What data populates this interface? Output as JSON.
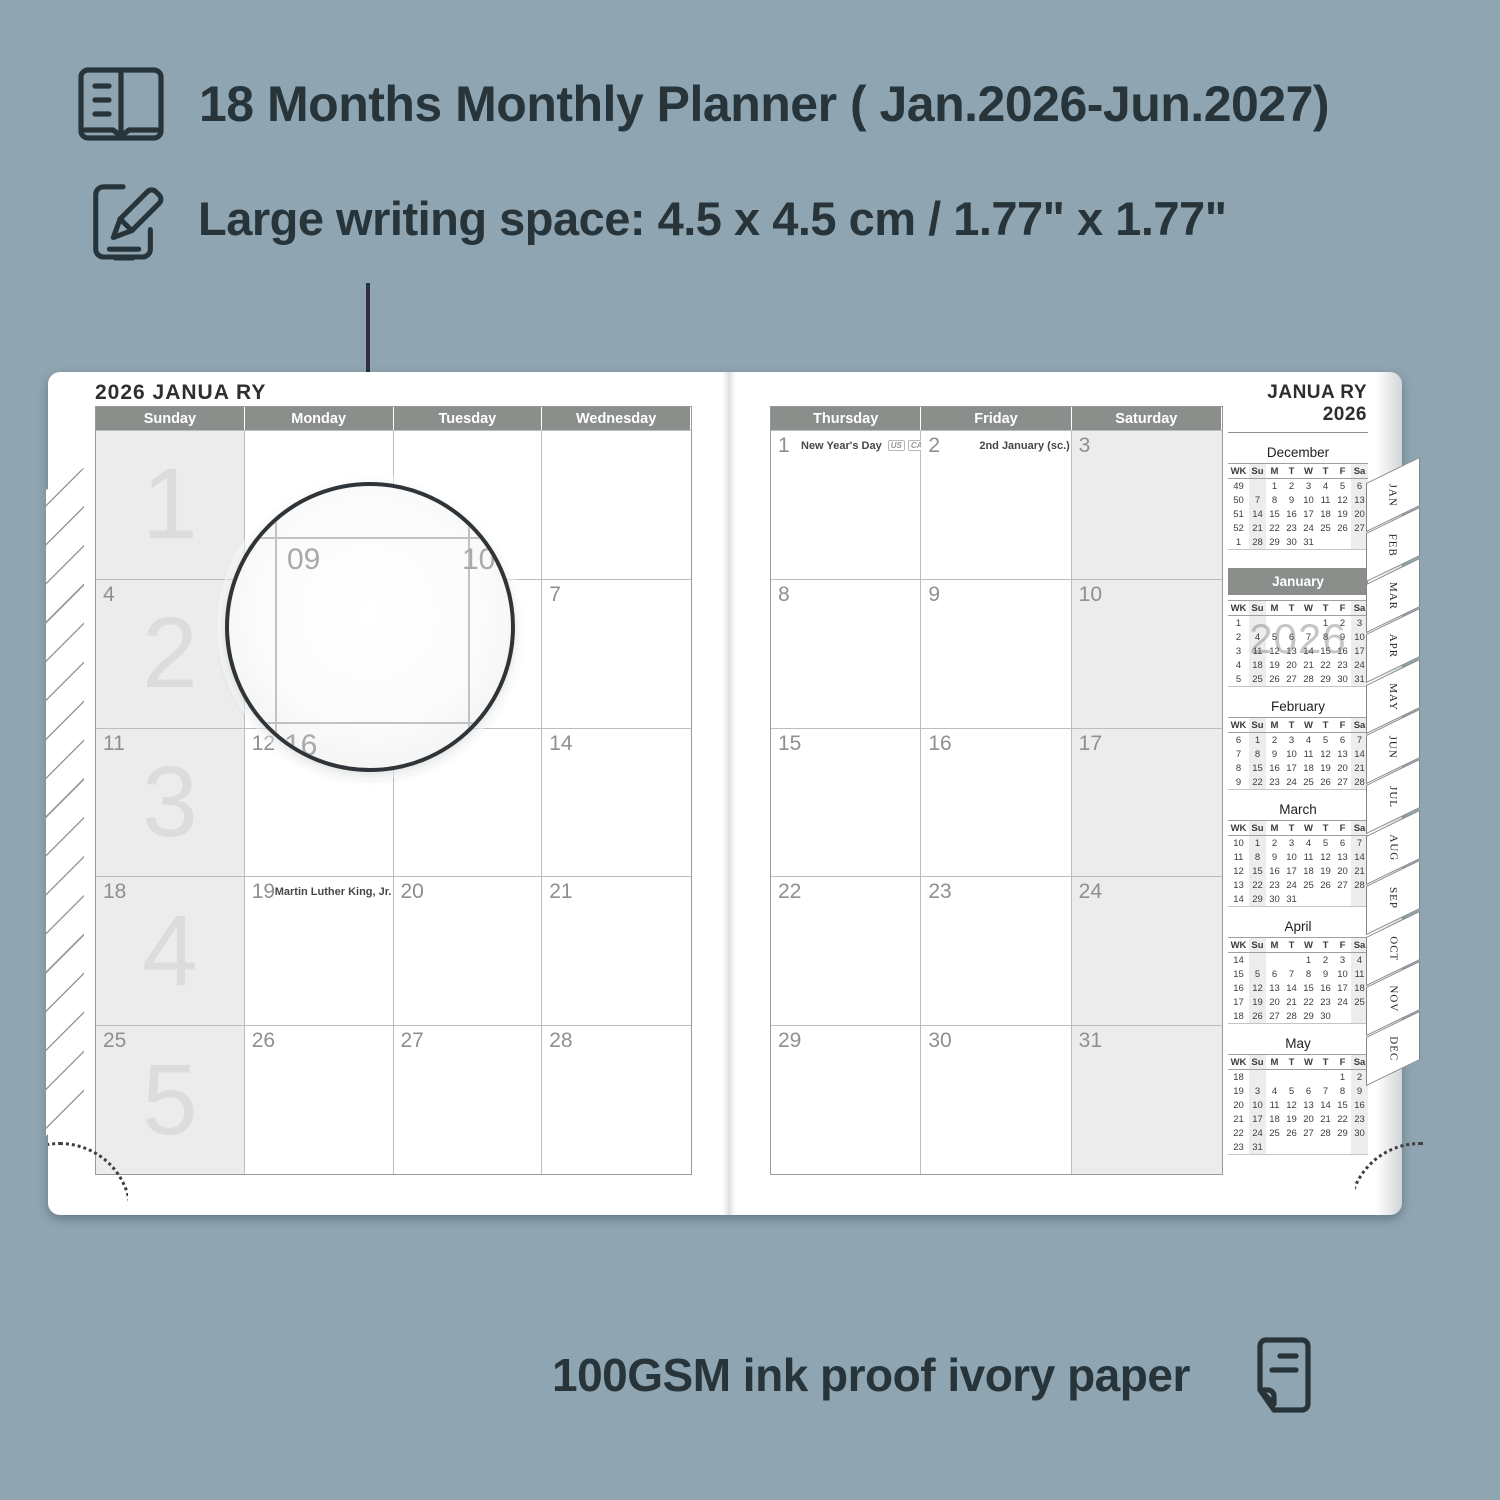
{
  "features": {
    "planner": "18 Months Monthly Planner ( Jan.2026-Jun.2027)",
    "writing_space": "Large writing space: 4.5 x 4.5 cm / 1.77\" x 1.77\"",
    "paper": "100GSM ink proof ivory paper"
  },
  "left_page": {
    "title": "2026 JANUA RY",
    "day_headers": [
      "Sunday",
      "Monday",
      "Tuesday",
      "Wednesday"
    ],
    "weeks": [
      {
        "week_number": "1",
        "cells": [
          {
            "date": "",
            "shaded": true
          },
          {
            "date": ""
          },
          {
            "date": ""
          },
          {
            "date": ""
          }
        ]
      },
      {
        "week_number": "2",
        "cells": [
          {
            "date": "4",
            "shaded": true
          },
          {
            "date": "5"
          },
          {
            "date": "6"
          },
          {
            "date": "7"
          }
        ]
      },
      {
        "week_number": "3",
        "cells": [
          {
            "date": "11",
            "shaded": true
          },
          {
            "date": "12"
          },
          {
            "date": "13"
          },
          {
            "date": "14"
          }
        ]
      },
      {
        "week_number": "4",
        "cells": [
          {
            "date": "18",
            "shaded": true
          },
          {
            "date": "19",
            "holiday": "Martin Luther King, Jr. Day",
            "badges": [
              "US"
            ]
          },
          {
            "date": "20"
          },
          {
            "date": "21"
          }
        ]
      },
      {
        "week_number": "5",
        "cells": [
          {
            "date": "25",
            "shaded": true
          },
          {
            "date": "26"
          },
          {
            "date": "27"
          },
          {
            "date": "28"
          }
        ]
      }
    ]
  },
  "right_page": {
    "day_headers": [
      "Thursday",
      "Friday",
      "Saturday"
    ],
    "weeks": [
      {
        "cells": [
          {
            "date": "1",
            "holiday": "New Year's Day",
            "badges": [
              "US",
              "CA",
              "UK",
              "IE"
            ]
          },
          {
            "date": "2",
            "holiday": "2nd January (sc.)",
            "badges": [
              "UK"
            ],
            "pushed": true
          },
          {
            "date": "3",
            "shaded": true
          }
        ]
      },
      {
        "cells": [
          {
            "date": "8"
          },
          {
            "date": "9"
          },
          {
            "date": "10",
            "shaded": true
          }
        ]
      },
      {
        "cells": [
          {
            "date": "15"
          },
          {
            "date": "16"
          },
          {
            "date": "17",
            "shaded": true
          }
        ]
      },
      {
        "cells": [
          {
            "date": "22"
          },
          {
            "date": "23"
          },
          {
            "date": "24",
            "shaded": true
          }
        ]
      },
      {
        "cells": [
          {
            "date": "29"
          },
          {
            "date": "30"
          },
          {
            "date": "31",
            "shaded": true
          }
        ]
      }
    ]
  },
  "sidebar": {
    "title": "JANUA RY 2026",
    "mini_header": [
      "WK",
      "Su",
      "M",
      "T",
      "W",
      "T",
      "F",
      "Sa"
    ],
    "months": [
      {
        "name": "December",
        "highlighted": false,
        "rows": [
          [
            "49",
            "",
            "1",
            "2",
            "3",
            "4",
            "5",
            "6"
          ],
          [
            "50",
            "7",
            "8",
            "9",
            "10",
            "11",
            "12",
            "13"
          ],
          [
            "51",
            "14",
            "15",
            "16",
            "17",
            "18",
            "19",
            "20"
          ],
          [
            "52",
            "21",
            "22",
            "23",
            "24",
            "25",
            "26",
            "27"
          ],
          [
            "1",
            "28",
            "29",
            "30",
            "31",
            "",
            "",
            ""
          ]
        ]
      },
      {
        "name": "January",
        "highlighted": true,
        "watermark": "2026",
        "rows": [
          [
            "1",
            "",
            "",
            "",
            "",
            "1",
            "2",
            "3"
          ],
          [
            "2",
            "4",
            "5",
            "6",
            "7",
            "8",
            "9",
            "10"
          ],
          [
            "3",
            "11",
            "12",
            "13",
            "14",
            "15",
            "16",
            "17"
          ],
          [
            "4",
            "18",
            "19",
            "20",
            "21",
            "22",
            "23",
            "24"
          ],
          [
            "5",
            "25",
            "26",
            "27",
            "28",
            "29",
            "30",
            "31"
          ]
        ]
      },
      {
        "name": "February",
        "highlighted": false,
        "rows": [
          [
            "6",
            "1",
            "2",
            "3",
            "4",
            "5",
            "6",
            "7"
          ],
          [
            "7",
            "8",
            "9",
            "10",
            "11",
            "12",
            "13",
            "14"
          ],
          [
            "8",
            "15",
            "16",
            "17",
            "18",
            "19",
            "20",
            "21"
          ],
          [
            "9",
            "22",
            "23",
            "24",
            "25",
            "26",
            "27",
            "28"
          ]
        ]
      },
      {
        "name": "March",
        "highlighted": false,
        "rows": [
          [
            "10",
            "1",
            "2",
            "3",
            "4",
            "5",
            "6",
            "7"
          ],
          [
            "11",
            "8",
            "9",
            "10",
            "11",
            "12",
            "13",
            "14"
          ],
          [
            "12",
            "15",
            "16",
            "17",
            "18",
            "19",
            "20",
            "21"
          ],
          [
            "13",
            "22",
            "23",
            "24",
            "25",
            "26",
            "27",
            "28"
          ],
          [
            "14",
            "29",
            "30",
            "31",
            "",
            "",
            "",
            ""
          ]
        ]
      },
      {
        "name": "April",
        "highlighted": false,
        "rows": [
          [
            "14",
            "",
            "",
            "",
            "1",
            "2",
            "3",
            "4"
          ],
          [
            "15",
            "5",
            "6",
            "7",
            "8",
            "9",
            "10",
            "11"
          ],
          [
            "16",
            "12",
            "13",
            "14",
            "15",
            "16",
            "17",
            "18"
          ],
          [
            "17",
            "19",
            "20",
            "21",
            "22",
            "23",
            "24",
            "25"
          ],
          [
            "18",
            "26",
            "27",
            "28",
            "29",
            "30",
            "",
            ""
          ]
        ]
      },
      {
        "name": "May",
        "highlighted": false,
        "rows": [
          [
            "18",
            "",
            "",
            "",
            "",
            "",
            "1",
            "2"
          ],
          [
            "19",
            "3",
            "4",
            "5",
            "6",
            "7",
            "8",
            "9"
          ],
          [
            "20",
            "10",
            "11",
            "12",
            "13",
            "14",
            "15",
            "16"
          ],
          [
            "21",
            "17",
            "18",
            "19",
            "20",
            "21",
            "22",
            "23"
          ],
          [
            "22",
            "24",
            "25",
            "26",
            "27",
            "28",
            "29",
            "30"
          ],
          [
            "23",
            "31",
            "",
            "",
            "",
            "",
            "",
            ""
          ]
        ]
      }
    ]
  },
  "tabs": [
    "JAN",
    "FEB",
    "MAR",
    "APR",
    "MAY",
    "JUN",
    "JUL",
    "AUG",
    "SEP",
    "OCT",
    "NOV",
    "DEC"
  ],
  "magnifier": {
    "top_left_date": "09",
    "top_right_date": "10",
    "bottom_left_date": "16"
  }
}
